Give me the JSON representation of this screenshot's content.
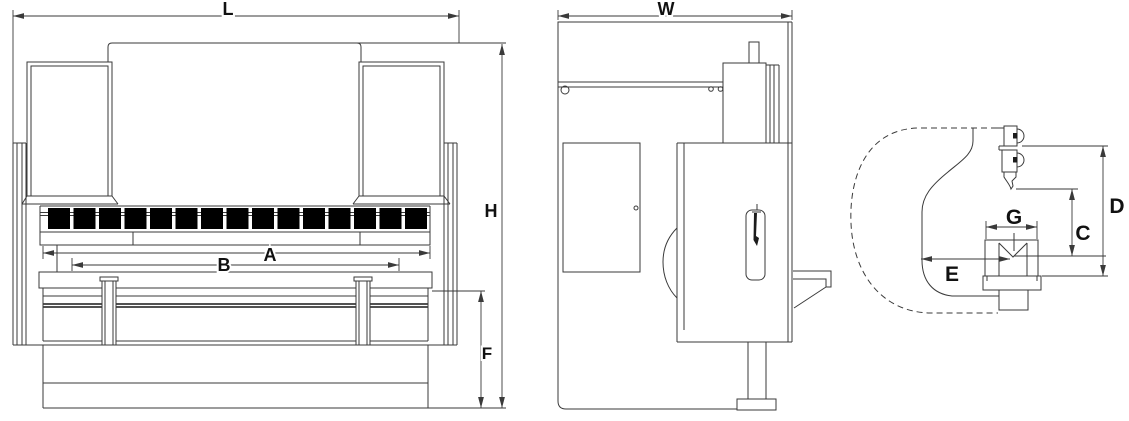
{
  "style": {
    "line_color": "#3a3a3a",
    "dark_fill": "#1c1c1c",
    "background": "#ffffff",
    "label_color": "#111111"
  },
  "front_view": {
    "clamp_count": 15,
    "dims": {
      "overall_length": "L",
      "overall_height": "H",
      "base_height": "F",
      "width_a": "A",
      "width_b": "B"
    }
  },
  "side_view": {
    "dims": {
      "overall_depth": "W"
    }
  },
  "detail_view": {
    "dims": {
      "die_width": "G",
      "open_height": "C",
      "daylight": "D",
      "throat_depth": "E"
    }
  }
}
